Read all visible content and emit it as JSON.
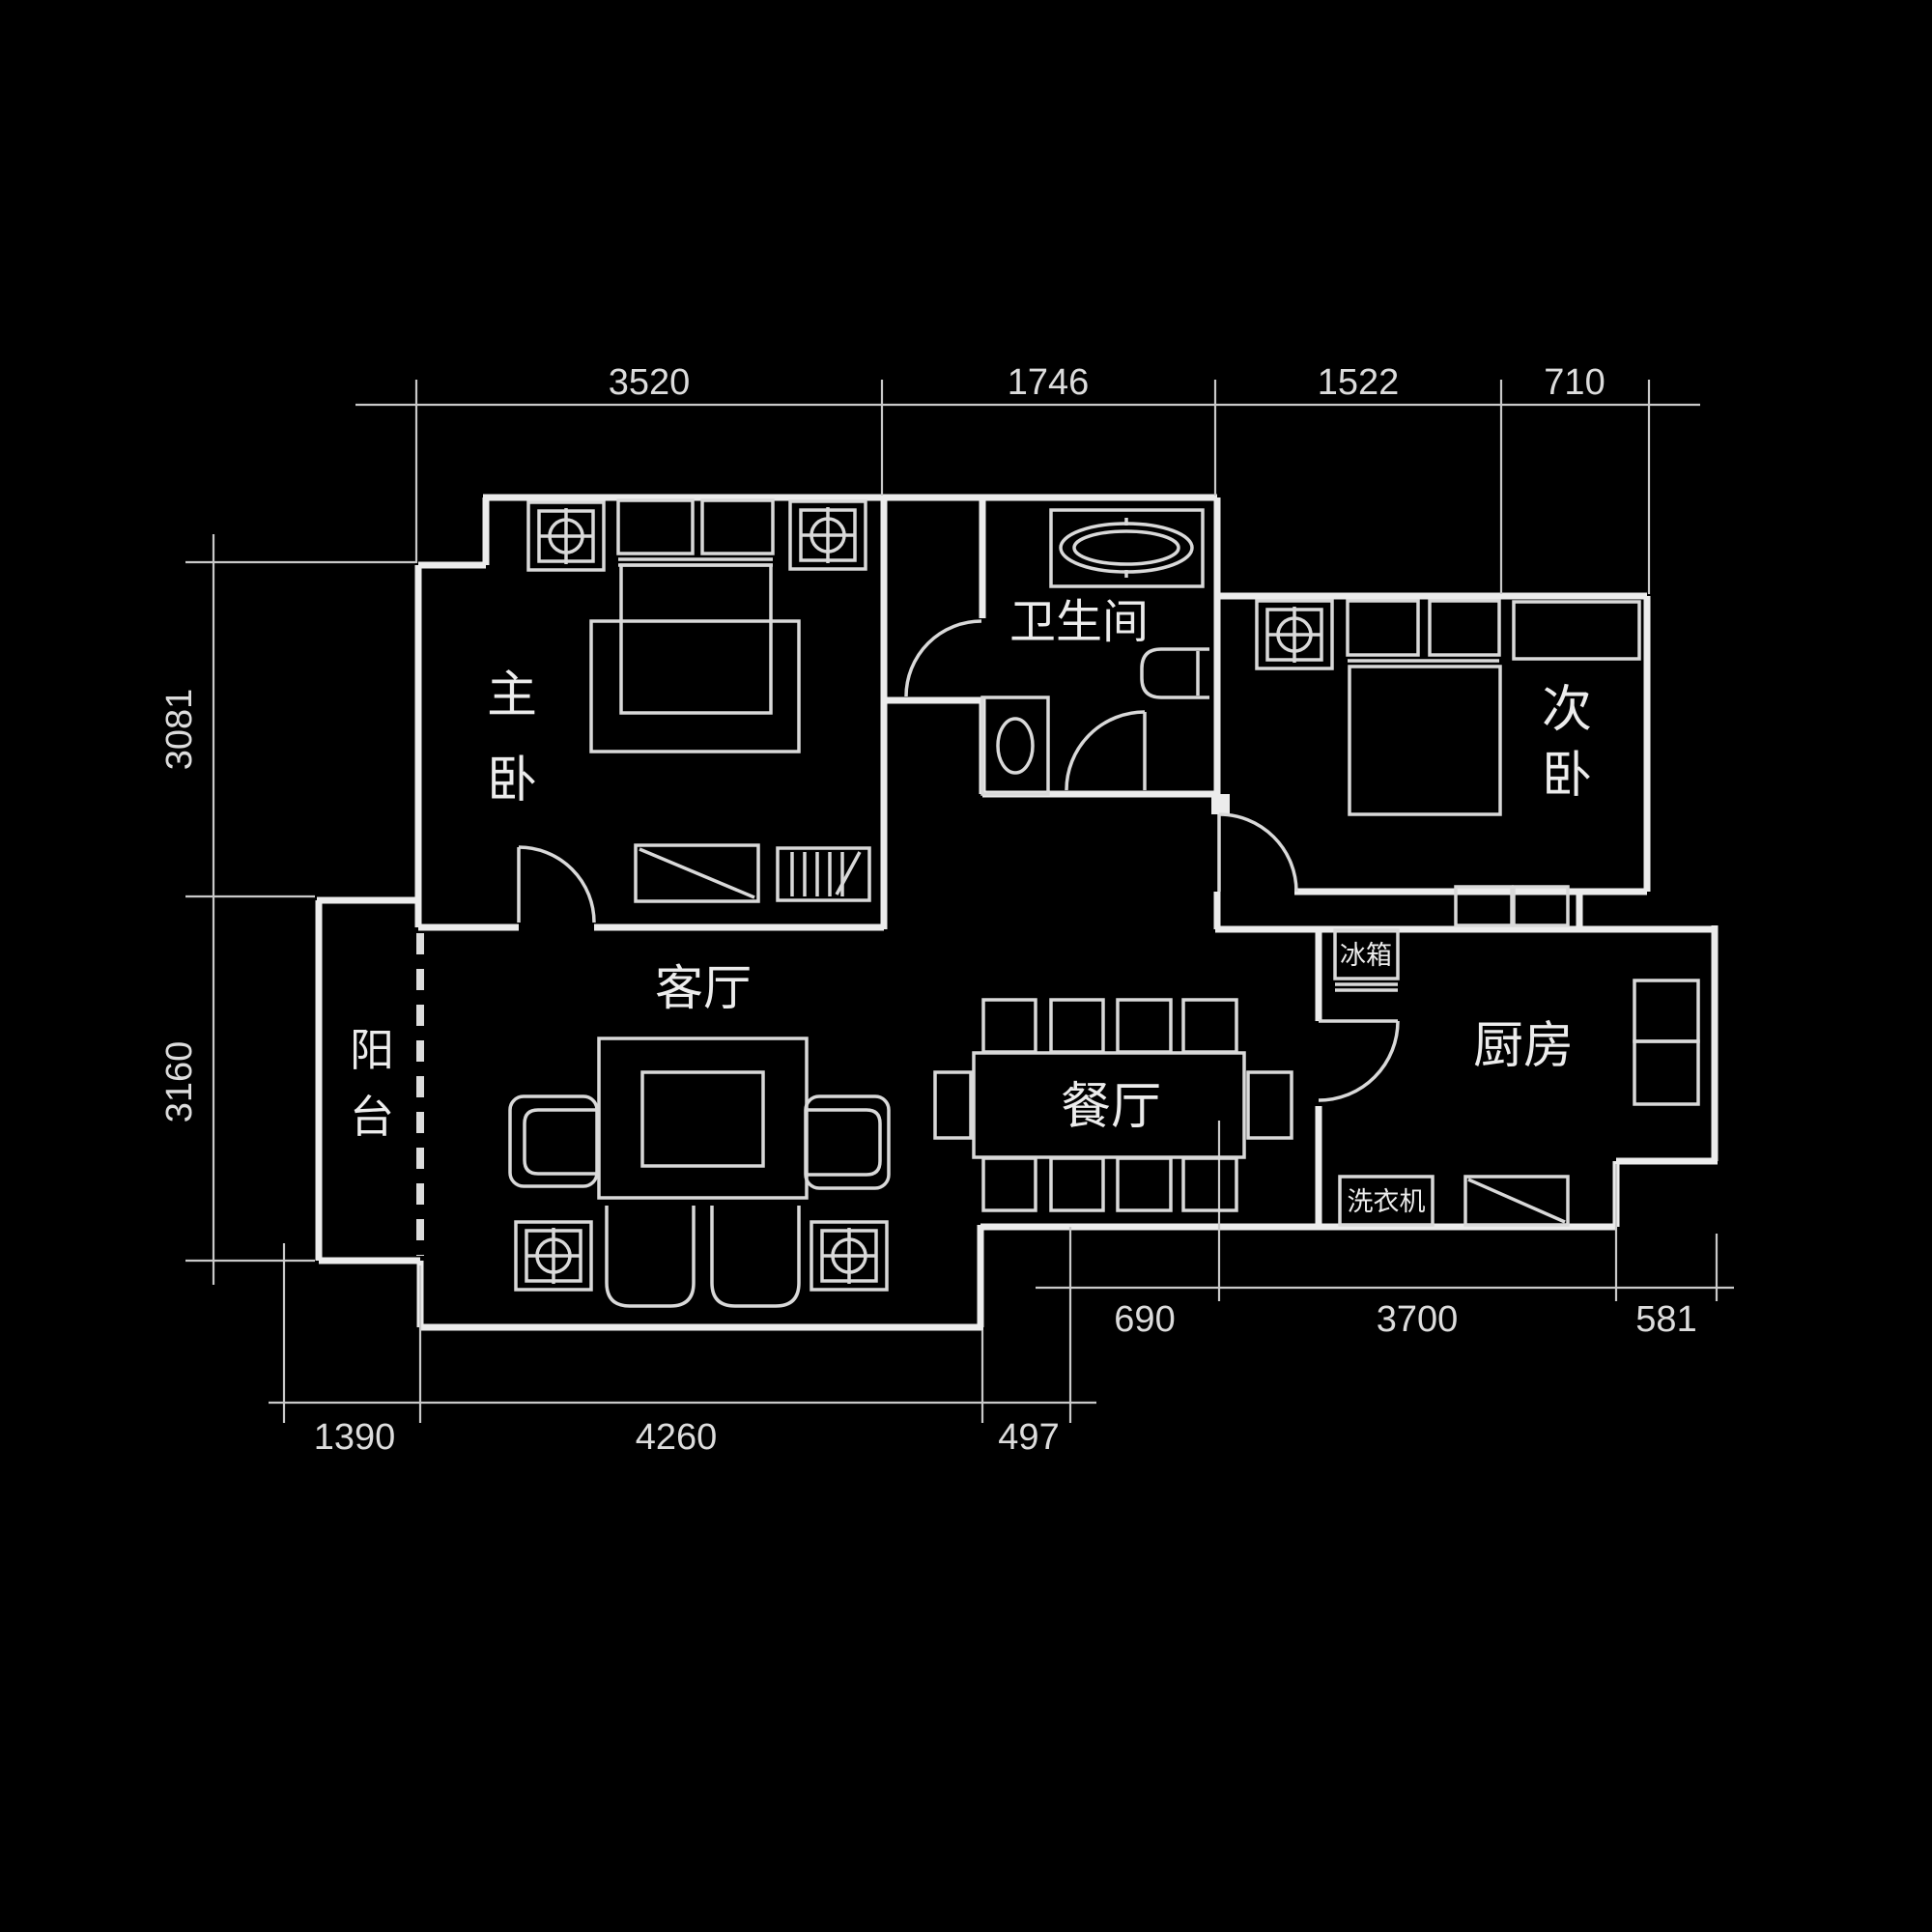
{
  "colors": {
    "background": "#000000",
    "wall_line": "#ececec",
    "furniture_line": "#d9d9d9",
    "dimension_line": "#c9c9c9",
    "text": "#eaeaea"
  },
  "rooms": {
    "master_bedroom": {
      "chars": [
        "主",
        "卧"
      ]
    },
    "second_bedroom": {
      "chars": [
        "次",
        "卧"
      ]
    },
    "balcony": {
      "chars": [
        "阳",
        "台"
      ]
    },
    "bathroom": "卫生间",
    "living_room": "客厅",
    "dining_room": "餐厅",
    "kitchen": "厨房",
    "fridge": "冰箱",
    "washing_machine": "洗衣机"
  },
  "dimensions_mm": {
    "top": {
      "d1": "3520",
      "d2": "1746",
      "d3": "1522",
      "d4": "710"
    },
    "left": {
      "d1": "3081",
      "d2": "3160"
    },
    "bottom_outer": {
      "d1": "1390",
      "d2": "4260",
      "d3": "497"
    },
    "bottom_inner": {
      "d1": "690",
      "d2": "3700",
      "d3": "581"
    }
  }
}
